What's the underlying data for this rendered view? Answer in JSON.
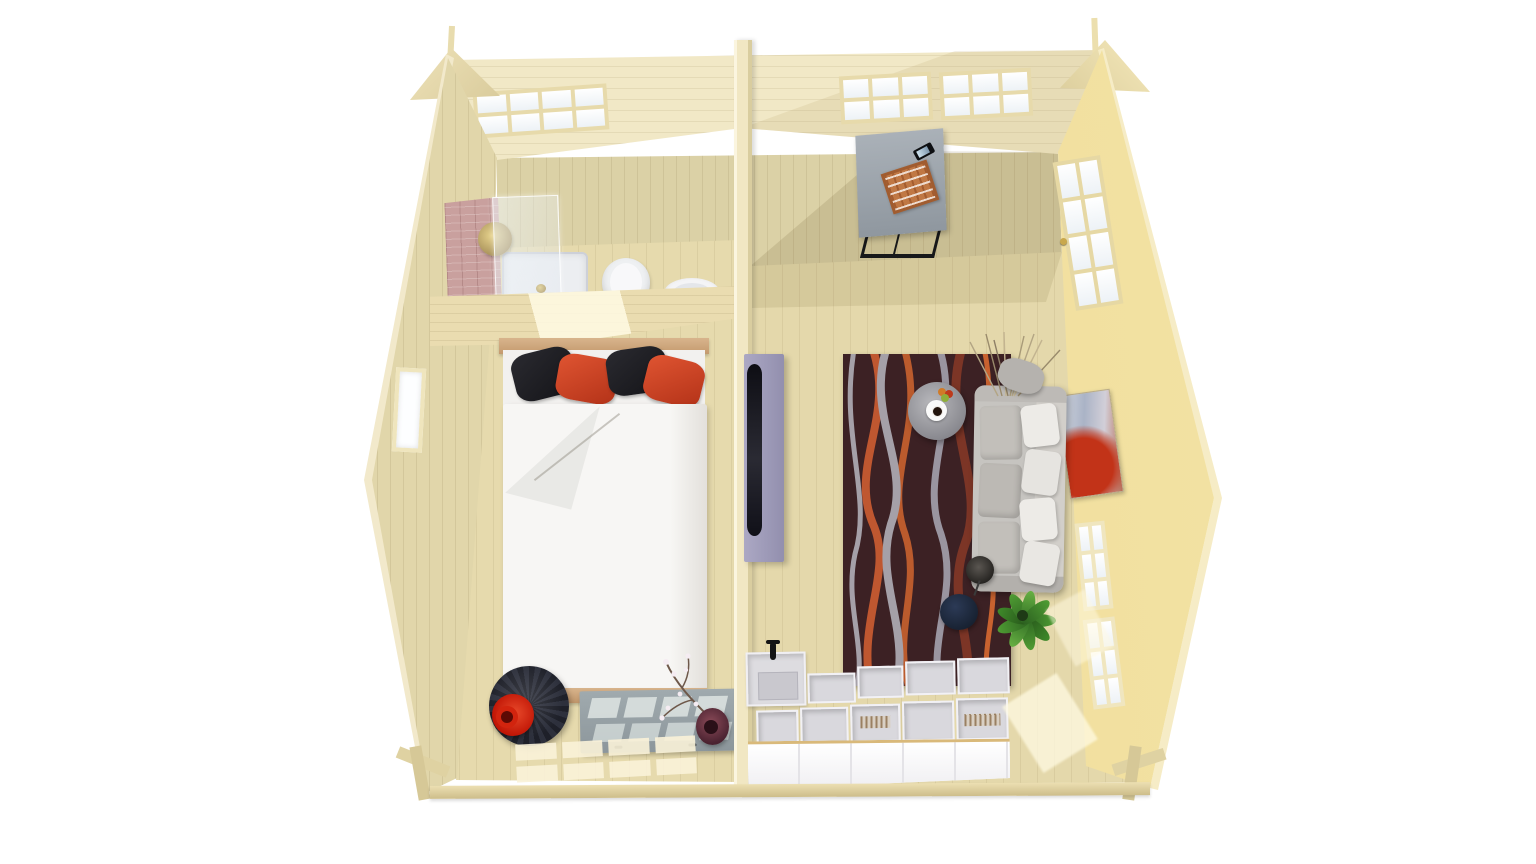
{
  "scene": {
    "title": "Top-down cutaway 3D render of a wooden log cabin interior with two rooms",
    "style": "photorealistic architectural visualization, roof removed, bird's-eye view",
    "background_color": "#ffffff",
    "shell": {
      "label": "Pale spruce log cabin shell seen from above",
      "wood_light": "#f2e9c8",
      "wood_wall": "#dbd1a6",
      "wood_floor": "#e6daad",
      "wood_sunlit": "#f0df9e",
      "divider_color": "#f1e7c3",
      "roof_label": "Roof edge and ceiling strip along the back wall",
      "back_windows_label": "Glazed window bands in the back wall",
      "gable_left_label": "Left gable tip with ridge batten",
      "gable_right_label": "Right gable tip with ridge batten",
      "left_window_label": "Small window in the left wall",
      "right_door_label": "Glazed single door in the right wall",
      "right_windows_label": "Two multi-pane windows in the right wall",
      "divider_label": "Full-height partition wall dividing the two rooms",
      "base_label": "Floor slab edge with foundation bearers"
    },
    "rooms": {
      "bedroom": {
        "label": "Bedroom with open shower corner",
        "items": {
          "tiled_wall": {
            "label": "Mauve tiled shower wall",
            "color": "#c9a09e"
          },
          "shower_glass": {
            "label": "Glass shower screen"
          },
          "shower_tray": {
            "label": "White square shower tray",
            "color": "#eceef1"
          },
          "shower_head": {
            "label": "Round brass rain shower head",
            "color": "#c9b36a"
          },
          "toilet": {
            "label": "White toilet seen from above",
            "color": "#f3f2f4"
          },
          "sink": {
            "label": "Round white wash basin",
            "color": "#f4f4f6"
          },
          "partition": {
            "label": "Half-height bathroom partition wall with sunlight patch"
          },
          "bed": {
            "label": "Double bed with white duvet and folded corner",
            "duvet_color": "#f7f6f4",
            "frame_color": "#cfa87e",
            "pillow_colors": [
              "#202024",
              "#cf4026",
              "#202024",
              "#cf4026"
            ]
          },
          "egg_chair": {
            "label": "Round dark swivel chair",
            "color": "#23242e"
          },
          "red_pot": {
            "label": "Red pot lying on the chair",
            "color": "#d42410"
          },
          "sideboard": {
            "label": "Grey sideboard with sunlight stripes",
            "color": "#98a2a6"
          },
          "blossom_vase": {
            "label": "Dark red vase with blossom branch",
            "color": "#6e3440"
          },
          "sun_patches": {
            "label": "Window light grid on bedroom floor"
          }
        }
      },
      "living_room": {
        "label": "Living room with kitchenette",
        "items": {
          "desk": {
            "label": "Grey desk with black steel legs",
            "color": "#9ba3ab"
          },
          "game_board": {
            "label": "Board game lying on the desk",
            "color": "#c57f48"
          },
          "phone": {
            "label": "Smartphone on the desk",
            "color": "#0f1114"
          },
          "tv": {
            "label": "Flat TV mounted on the room divider",
            "panel_color": "#a39fbc",
            "screen_color": "#15151c"
          },
          "rug": {
            "label": "Dark rug with wavy orange and grey stripes",
            "base_color": "#3c2124",
            "stripe_colors": [
              "#c2592c",
              "#a5a0a8",
              "#7c3526"
            ]
          },
          "coffee_table": {
            "label": "Round grey pedestal coffee table",
            "color": "#8f8f94"
          },
          "coffee_cup": {
            "label": "Coffee cup on saucer"
          },
          "fruit_bowl": {
            "label": "Small bowl of fruit",
            "color": "#d07a28"
          },
          "sofa": {
            "label": "Light grey sofa with white back cushions",
            "color": "#c2c0bd"
          },
          "grass_decor": {
            "label": "Dried grass arrangement behind the sofa"
          },
          "floor_lamp": {
            "label": "Dark floor lamp shade",
            "color": "#3a3734"
          },
          "pouf": {
            "label": "Navy round pouf",
            "color": "#202b40"
          },
          "plant": {
            "label": "Green potted plant",
            "color": "#47912f"
          },
          "painting": {
            "label": "Abstract painting with large red circle",
            "colors": [
              "#c23318",
              "#5a6fa8",
              "#ccd2da"
            ]
          },
          "kitchen": {
            "label": "White kitchen counter with open carcasses and black tap",
            "front_color": "#fbfafb",
            "faucet_color": "#151515"
          },
          "sun_pools": {
            "label": "Door light pools on the living room floor"
          }
        }
      }
    }
  }
}
